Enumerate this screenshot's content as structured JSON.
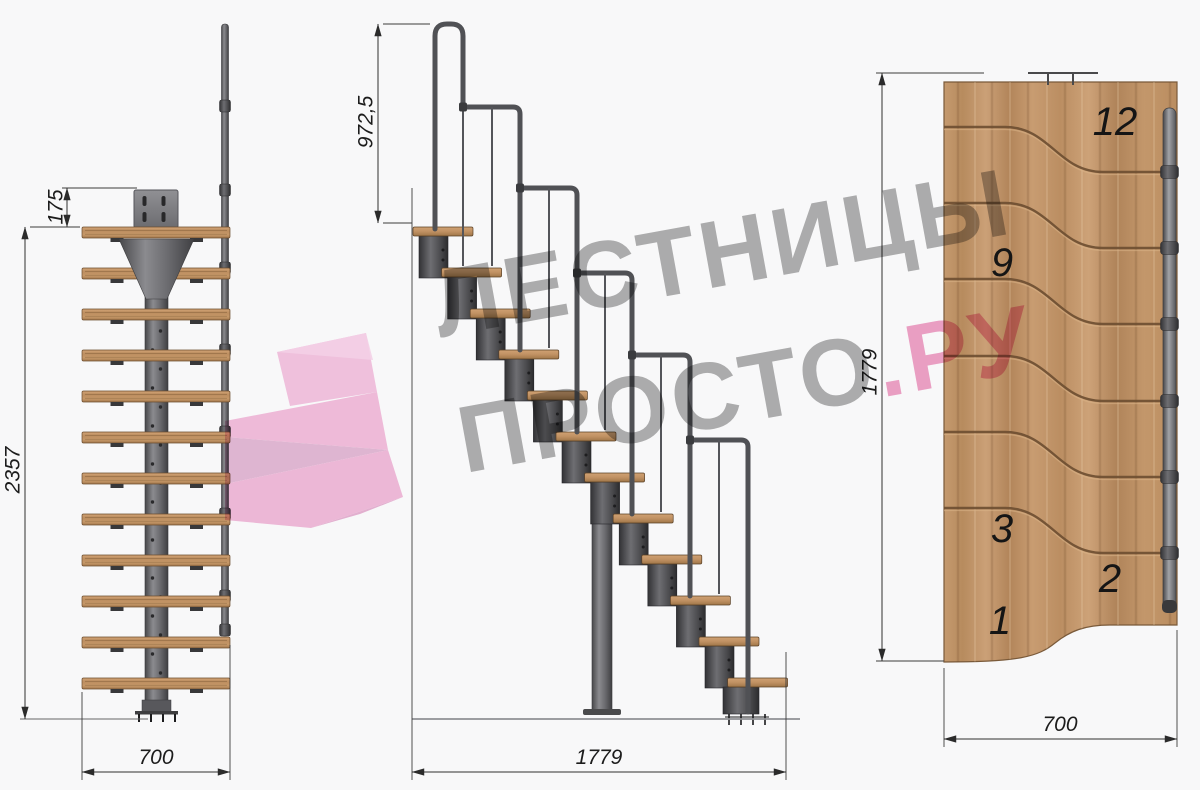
{
  "watermark": {
    "line1": "ЛЕСТНИЦЫ",
    "line2_gray": "ПРОСТО",
    "line2_pink": ".РУ"
  },
  "views": {
    "front": {
      "dims": {
        "plate_height": "175",
        "total_height": "2357",
        "width": "700"
      }
    },
    "side": {
      "dims": {
        "handrail_height": "972,5",
        "length": "1779"
      }
    },
    "plan": {
      "dims": {
        "length": "1779",
        "width": "700"
      },
      "step_labels": [
        "12",
        "9",
        "3",
        "2",
        "1"
      ]
    }
  },
  "colors": {
    "background": "#f8f8f9",
    "watermark_gray": "#b0b0b0",
    "watermark_pink": "#f0a3c7",
    "logo_pink": "#f5c0de",
    "wood": "#c49a6e",
    "wood_groove": "#6d4e31",
    "metal": "#505155",
    "dimension_line": "#2f2f2f"
  }
}
